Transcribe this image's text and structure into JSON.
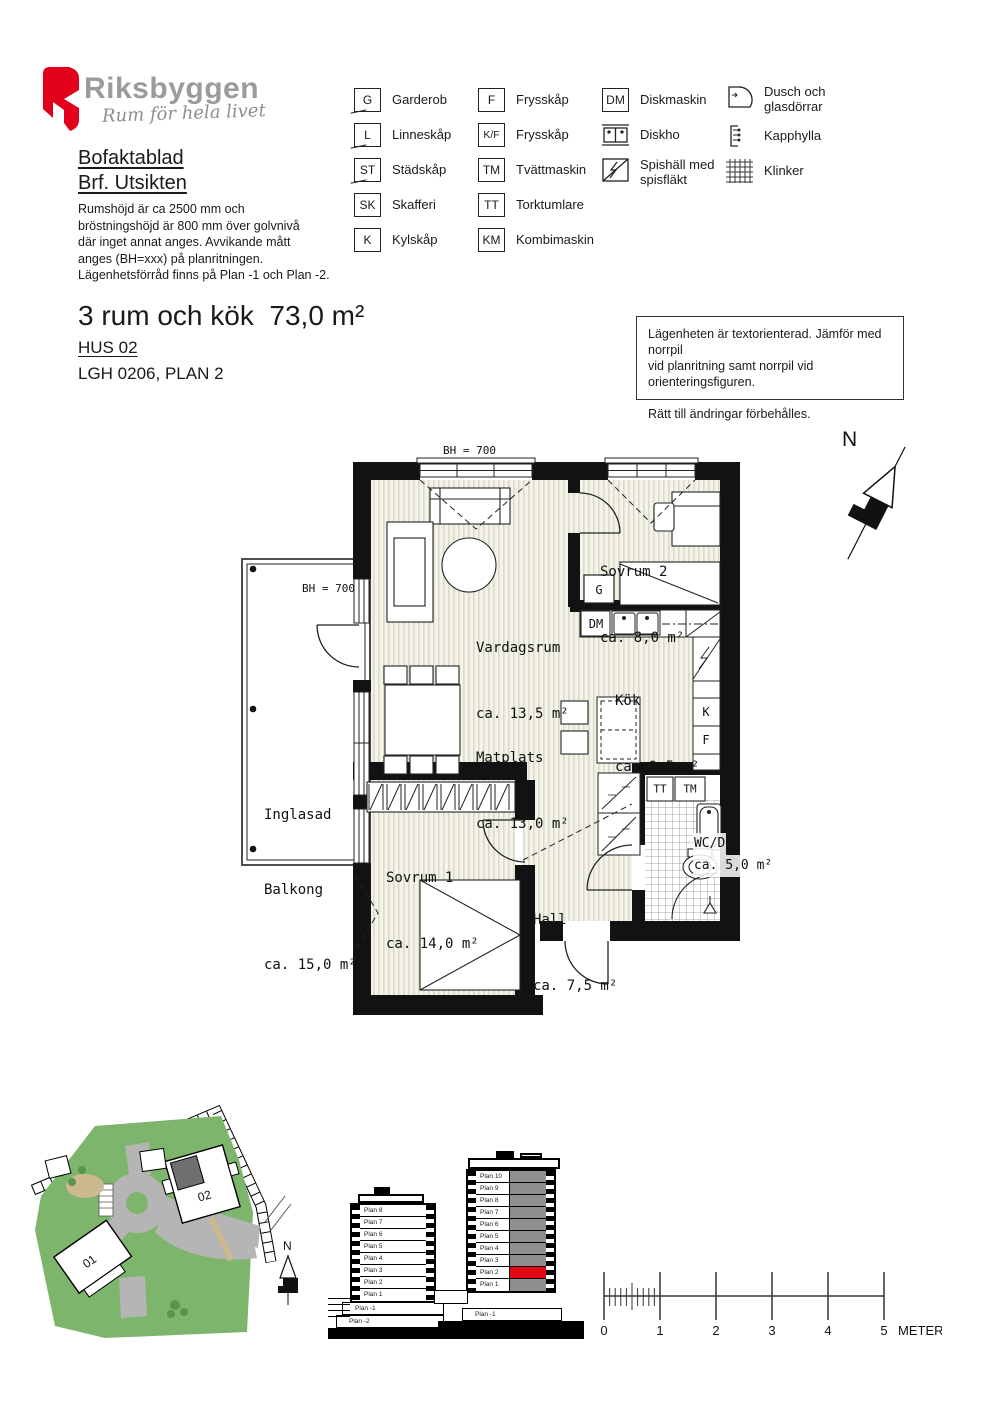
{
  "header": {
    "brand": "Riksbyggen",
    "tagline": "Rum för hela livet",
    "doc_title_line1": "Bofaktablad",
    "doc_title_line2": "Brf. Utsikten",
    "description": [
      "Rumshöjd är ca 2500 mm och",
      "bröstningshöjd är 800 mm över golvnivå",
      "där inget annat anges. Avvikande mått",
      "anges (BH=xxx) på planritningen.",
      "Lägenhetsförråd finns på Plan -1 och Plan -2."
    ]
  },
  "legend": {
    "col1": [
      {
        "code": "G",
        "label": "Garderob"
      },
      {
        "code": "L",
        "label": "Linneskåp"
      },
      {
        "code": "ST",
        "label": "Städskåp"
      },
      {
        "code": "SK",
        "label": "Skafferi"
      },
      {
        "code": "K",
        "label": "Kylskåp"
      }
    ],
    "col2": [
      {
        "code": "F",
        "label": "Frysskåp"
      },
      {
        "code": "K/F",
        "label": "Frysskåp"
      },
      {
        "code": "TM",
        "label": "Tvättmaskin"
      },
      {
        "code": "TT",
        "label": "Torktumlare"
      },
      {
        "code": "KM",
        "label": "Kombimaskin"
      }
    ],
    "col3": [
      {
        "code": "DM",
        "label": "Diskmaskin"
      },
      {
        "icon": "diskho",
        "label": "Diskho"
      },
      {
        "icon": "spishall",
        "label": "Spishäll med spisfläkt"
      }
    ],
    "col4": [
      {
        "icon": "dusch",
        "label": "Dusch och glasdörrar"
      },
      {
        "icon": "kapphylla",
        "label": "Kapphylla"
      },
      {
        "icon": "klinker",
        "label": "Klinker"
      }
    ]
  },
  "apartment": {
    "title": "3 rum och kök  73,0 m²",
    "house": "HUS 02",
    "unit": "LGH 0206, PLAN 2"
  },
  "note": {
    "line1": "Lägenheten är textorienterad. Jämför med norrpil",
    "line2": "vid planritning samt norrpil vid orienteringsfiguren.",
    "line3": "Rätt till ändringar förbehålles."
  },
  "north_label": "N",
  "plan": {
    "bh_top": "BH = 700",
    "bh_balcony": "BH = 700",
    "rooms": {
      "vardagsrum": {
        "name": "Vardagsrum",
        "area": "ca. 13,5 m²"
      },
      "sovrum2": {
        "name": "Sovrum 2",
        "area": "ca. 8,0 m²"
      },
      "kok": {
        "name": "Kök",
        "area": "ca. 9,5 m²"
      },
      "matplats": {
        "name": "Matplats",
        "area": "ca. 13,0 m²"
      },
      "sovrum1": {
        "name": "Sovrum 1",
        "area": "ca. 14,0 m²"
      },
      "hall": {
        "name": "Hall",
        "area": "ca. 7,5 m²"
      },
      "wcd": {
        "name": "WC/D",
        "area": "ca. 5,0 m²"
      },
      "balkong": {
        "name1": "Inglasad",
        "name2": "Balkong",
        "area": "ca. 15,0 m²"
      }
    },
    "markers": {
      "g": "G",
      "dm": "DM",
      "k": "K",
      "f": "F",
      "tt": "TT",
      "tm": "TM"
    }
  },
  "site": {
    "building1": "01",
    "building2": "02",
    "north": "N"
  },
  "elevations": {
    "left_upper": [
      "Plan 8",
      "Plan 7",
      "Plan 6",
      "Plan 5",
      "Plan 4",
      "Plan 3",
      "Plan 2",
      "Plan 1"
    ],
    "left_basement": [
      "Plan -1",
      "Plan -2"
    ],
    "right_upper": [
      "Plan 10",
      "Plan 9",
      "Plan 8",
      "Plan 7",
      "Plan 6",
      "Plan 5",
      "Plan 4",
      "Plan 3",
      "Plan 2",
      "Plan 1"
    ],
    "right_basement": "Plan -1",
    "highlight": "Plan 2"
  },
  "scale": {
    "labels": [
      "0",
      "1",
      "2",
      "3",
      "4",
      "5"
    ],
    "unit": "METER"
  },
  "colors": {
    "brand_red": "#e2001a",
    "site_green": "#7db56c",
    "road_gray": "#b5b5b5",
    "dark_block": "#6f6f6f",
    "highlight_red": "#e30613",
    "floor_gray": "#8f8f8f"
  }
}
